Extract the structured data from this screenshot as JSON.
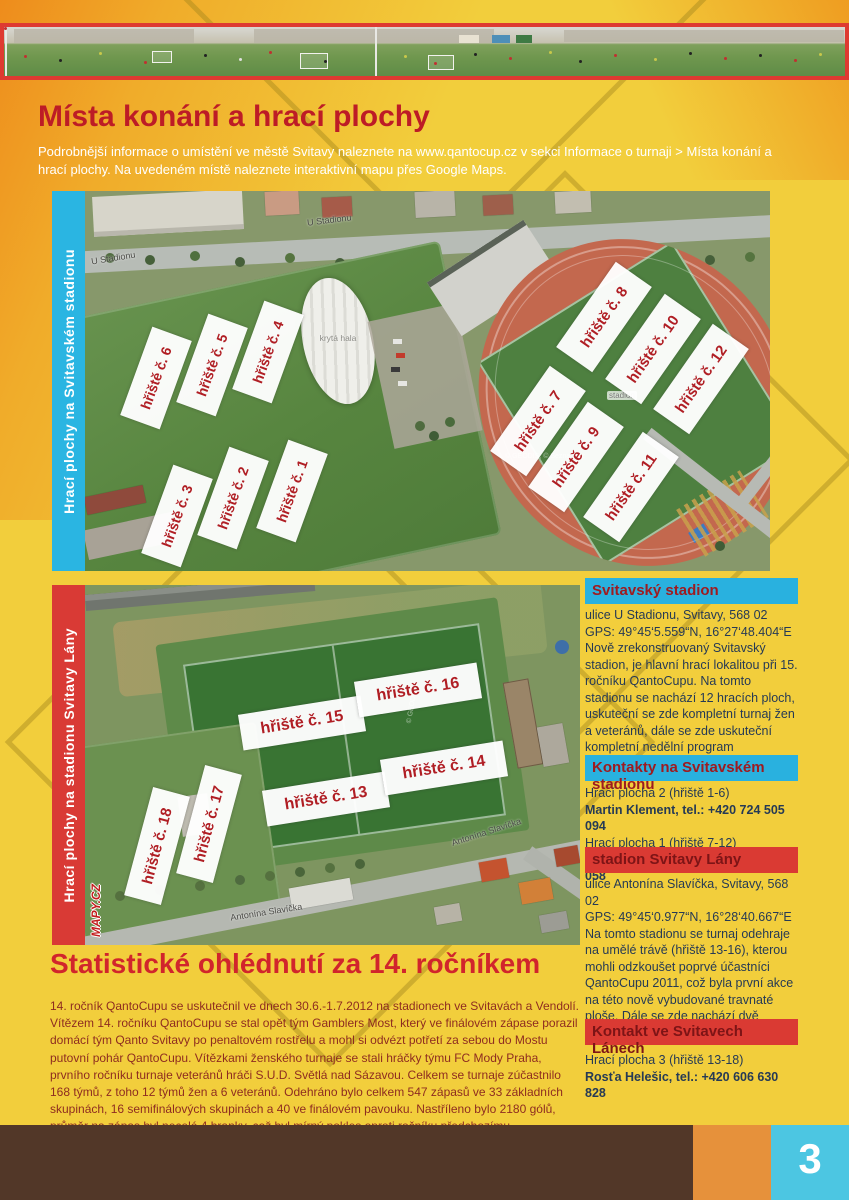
{
  "intro": {
    "title": "Místa konání a hrací plochy",
    "subtitle": "Podrobnější informace o umístění ve městě Svitavy naleznete na www.qantocup.cz v sekci Informace o turnaji > Místa konání a hrací plochy. Na uvedeném místě naleznete interaktivní mapu přes Google Maps."
  },
  "map1": {
    "strip_label": "Hrací plochy na Svitavském stadionu",
    "street_label_1": "U Stadionu",
    "street_label_2": "U Stadionu",
    "hall_label": "krytá hala",
    "stadium_label": "stadion",
    "credit": "© GEODIS, © Seznam.cz",
    "labels": [
      "hřiště č. 6",
      "hřiště č. 5",
      "hřiště č. 4",
      "hřiště č. 3",
      "hřiště č. 2",
      "hřiště č. 1",
      "hřiště č. 8",
      "hřiště č. 10",
      "hřiště č. 12",
      "hřiště č. 7",
      "hřiště č. 9",
      "hřiště č. 11"
    ]
  },
  "map2": {
    "strip_label": "Hrací plochy na stadionu Svitavy Lány",
    "street_label_1": "Antonína Slavíčka",
    "street_label_2": "Antonína Slavíčka",
    "watermark": "MAPY.CZ",
    "credit": "© GEODIS",
    "labels": [
      "hřiště č. 15",
      "hřiště č. 16",
      "hřiště č. 13",
      "hřiště č. 14",
      "hřiště č. 17",
      "hřiště č. 18"
    ]
  },
  "sidebar": {
    "box1": {
      "title": "Svitavský stadion",
      "address": "ulice U Stadionu, Svitavy, 568 02",
      "gps": "GPS: 49°45‘5.559“N, 16°27‘48.404“E",
      "text": "Nově zrekonstruovaný Svitavský stadion, je hlavní hrací lokalitou při 15. ročníku QantoCupu. Na tomto stadionu se nachází 12 hracích ploch, uskuteční se zde kompletní turnaj žen a veteránů, dále se zde uskuteční kompletní nedělní program QantoCupu."
    },
    "box2": {
      "title": "Kontakty na Svitavském stadionu",
      "line1_label": "Hrací plocha 2 (hřiště 1-6)",
      "line1_contact": "Martin Klement, tel.: +420 724 505 094",
      "line2_label": "Hrací plocha 1 (hřiště 7-12)",
      "line2_contact": "Míroslav Mach, tel.: +420 724 505 058"
    },
    "box3": {
      "title": "stadion Svitavy Lány",
      "address": "ulice Antonína Slavíčka, Svitavy, 568 02",
      "gps": "GPS: 49°45‘0.977“N, 16°28‘40.667“E",
      "text": "Na tomto stadionu se turnaj odehraje na umělé trávě (hřiště 13-16), kterou mohli odzkoušet poprvé účastníci QantoCupu 2011, což byla první akce na této nově vybudované travnaté ploše. Dále se zde nachází dvě travnaté hrací plochy (hřiště 17-18)."
    },
    "box4": {
      "title": "Kontakt ve Svitavech Lánech",
      "line_label": "Hrací plocha 3 (hřiště 13-18)",
      "contact": "Rosťa Helešic, tel.: +420 606 630 828"
    }
  },
  "stats": {
    "title": "Statistické ohlédnutí za 14. ročníkem",
    "body": "14. ročník QantoCupu se uskutečnil ve dnech 30.6.-1.7.2012 na stadionech ve Svitavách a Vendolí. Vítězem 14. ročníku QantoCupu se stal opět tým Gamblers Most, který ve finálovém zápase porazil domácí tým Qanto Svitavy po penaltovém rostřelu a mohl si odvézt potřetí za sebou do Mostu putovní pohár QantoCupu. Vítězkami ženského turnaje se stali hráčky týmu FC Mody Praha, prvního ročníku turnaje veteránů hráči S.U.D. Světlá nad Sázavou. Celkem se turnaje zúčastnilo 168 týmů, z toho 12 týmů žen a 6 veteránů. Odehráno bylo celkem 547 zápasů ve 33 základních skupinách, 16 semifinálových skupinách a 40 ve finálovém pavouku. Nastříleno bylo 2180 gólů, průměr na zápas byl necelé 4 branky, což byl mírný pokles oproti ročníku předchozímu."
  },
  "footer": {
    "page_number": "3"
  },
  "colors": {
    "background_yellow": "#F2CE3C",
    "background_orange": "#EE8C1C",
    "cyan": "#29B1DF",
    "red": "#DA3A33",
    "label_red": "#B01E24",
    "heading_red": "#BD1C26",
    "body_navy": "#263A55",
    "stats_red": "#8E2C20",
    "footer_brown": "#523728",
    "footer_orange": "#E6913B",
    "footer_cyan": "#4CC6E2"
  }
}
